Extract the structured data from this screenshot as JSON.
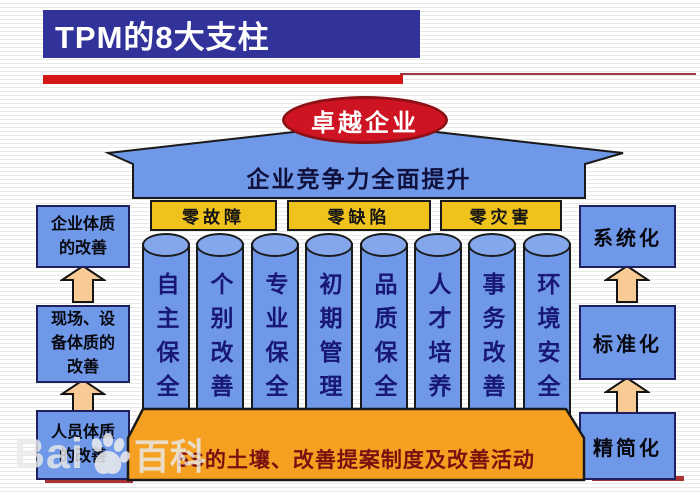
{
  "title_bar": {
    "text": "TPM的8大支柱"
  },
  "diagram": {
    "apex": {
      "label": "卓越企业"
    },
    "roof": {
      "label": "企业竞争力全面提升"
    },
    "banners": [
      "零故障",
      "零缺陷",
      "零灾害"
    ],
    "pillars": [
      "自主保全",
      "个别改善",
      "专业保全",
      "初期管理",
      "品质保全",
      "人才培养",
      "事务改善",
      "环境安全"
    ],
    "base": {
      "label": "5S的土壤、改善提案制度及改善活动"
    },
    "left_flow": {
      "boxes": [
        {
          "lines": [
            "企业体质",
            "的改善"
          ]
        },
        {
          "lines": [
            "现场、设",
            "备体质的",
            "改善"
          ]
        },
        {
          "lines": [
            "人员体质",
            "的改善"
          ]
        }
      ]
    },
    "right_flow": {
      "boxes": [
        {
          "label": "系统化"
        },
        {
          "label": "标准化"
        },
        {
          "label": "精简化"
        }
      ]
    }
  },
  "watermark": {
    "prefix": "Bai",
    "suffix": "百科",
    "icon": "baidu-paw-icon"
  },
  "colors": {
    "title_bar_blue": "#32329b",
    "accent_red": "#d31616",
    "apex_red": "#ce1322",
    "structure_blue": "#6f99e8",
    "banner_gold": "#f0c31c",
    "base_orange": "#f5a021",
    "arrow_peach": "#f8cb95",
    "pillar_text_navy": "#181874",
    "base_text_maroon": "#7c1010"
  }
}
